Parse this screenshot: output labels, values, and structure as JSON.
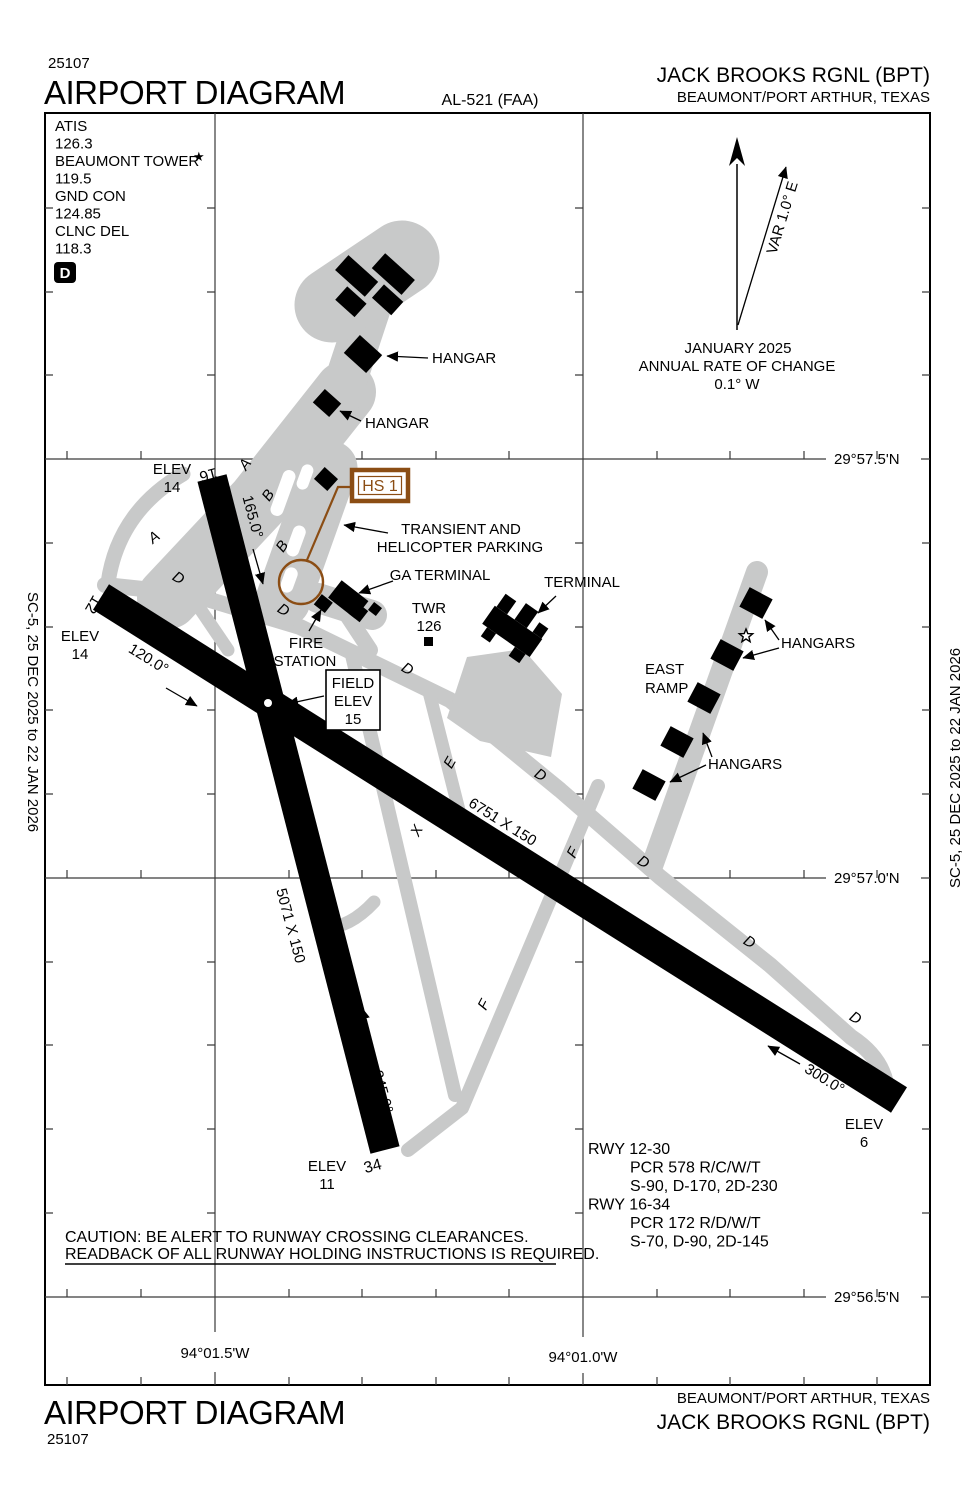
{
  "colors": {
    "taxiway_gray": "#c8c9c9",
    "hotspot_brown": "#8b4d14",
    "runway_black": "#000000"
  },
  "header": {
    "chart_code": "25107",
    "title": "AIRPORT DIAGRAM",
    "al_number": "AL-521 (FAA)",
    "airport_name": "JACK BROOKS RGNL (BPT)",
    "city": "BEAUMONT/PORT ARTHUR, TEXAS"
  },
  "footer": {
    "chart_code": "25107",
    "title": "AIRPORT DIAGRAM",
    "airport_name": "JACK BROOKS RGNL (BPT)",
    "city": "BEAUMONT/PORT ARTHUR, TEXAS"
  },
  "margin_note_left": "SC-5,  25 DEC 2025  to  22 JAN 2026",
  "margin_note_right": "SC-5,  25 DEC 2025  to  22 JAN 2026",
  "comm_box": {
    "atis_label": "ATIS",
    "atis_freq": "126.3",
    "tower_label": "BEAUMONT TOWER",
    "tower_star": "★",
    "tower_freq": "119.5",
    "gnd_label": "GND CON",
    "gnd_freq": "124.85",
    "clnc_label": "CLNC DEL",
    "clnc_freq": "118.3",
    "datalink_symbol": "D"
  },
  "north_indicator": {
    "variation": "VAR 1.0° E",
    "date": "JANUARY 2025",
    "rate_line1": "ANNUAL RATE OF CHANGE",
    "rate_line2": "0.1° W"
  },
  "grid": {
    "lat_labels": [
      "29°57.5'N",
      "29°57.0'N",
      "29°56.5'N"
    ],
    "lon_labels": [
      "94°01.5'W",
      "94°01.0'W"
    ]
  },
  "diagram": {
    "hot_spot_label": "HS 1",
    "runway_12_30": {
      "number_12": "12",
      "number_30": "30",
      "heading_12": "120.0°",
      "heading_30": "300.0°",
      "dimensions": "6751 X 150",
      "elev_label": "ELEV",
      "elev_12": "14",
      "elev_30": "6"
    },
    "runway_16_34": {
      "number_16": "16",
      "number_34": "34",
      "heading_16": "165.0°",
      "heading_34": "345.0°",
      "dimensions": "5071 X 150",
      "elev_label": "ELEV",
      "elev_16": "14",
      "elev_34": "11"
    },
    "field_elev_box": {
      "line1": "FIELD",
      "line2": "ELEV",
      "line3": "15"
    },
    "labels": {
      "hangar_nw_upper": "HANGAR",
      "hangar_nw_lower": "HANGAR",
      "hangars_east_upper": "HANGARS",
      "hangars_east_lower": "HANGARS",
      "east_ramp_line1": "EAST",
      "east_ramp_line2": "RAMP",
      "terminal": "TERMINAL",
      "ga_terminal": "GA TERMINAL",
      "twr_line1": "TWR",
      "twr_line2": "126",
      "fire_station_line1": "FIRE",
      "fire_station_line2": "STATION",
      "transient_line1": "TRANSIENT AND",
      "transient_line2": "HELICOPTER PARKING"
    },
    "taxiway_letters": [
      "A",
      "B",
      "A",
      "B",
      "D",
      "D",
      "D",
      "E",
      "D",
      "X",
      "F",
      "D",
      "X",
      "D",
      "D",
      "F"
    ]
  },
  "runway_data": {
    "rwy_12_30_title": "RWY 12-30",
    "rwy_12_30_pcr": "PCR 578 R/C/W/T",
    "rwy_12_30_strengths": "S-90, D-170, 2D-230",
    "rwy_16_34_title": "RWY 16-34",
    "rwy_16_34_pcr": "PCR 172 R/D/W/T",
    "rwy_16_34_strengths": "S-70, D-90, 2D-145"
  },
  "caution": {
    "line1": "CAUTION:  BE ALERT TO RUNWAY CROSSING CLEARANCES.",
    "line2": "READBACK OF ALL RUNWAY HOLDING INSTRUCTIONS IS REQUIRED."
  }
}
